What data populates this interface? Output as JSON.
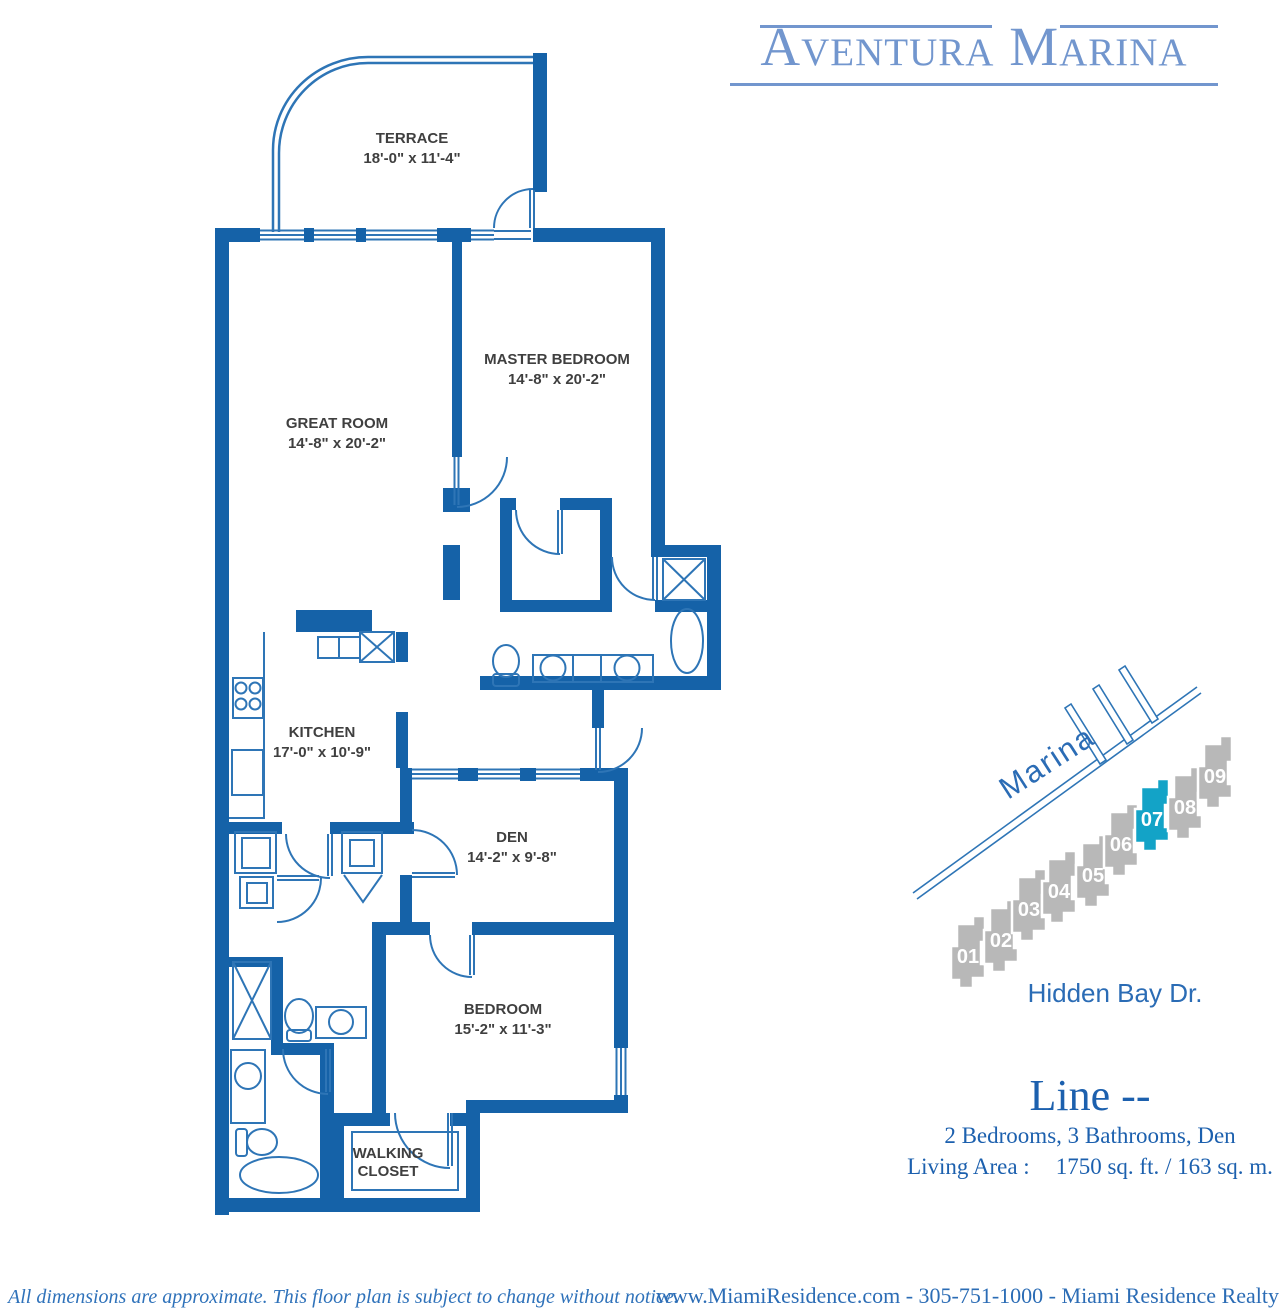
{
  "brand": {
    "logo_text": "Aventura Marina"
  },
  "floorplan": {
    "rooms": {
      "terrace": {
        "name": "TERRACE",
        "dims": "18'-0\" x 11'-4\""
      },
      "master_bedroom": {
        "name": "MASTER BEDROOM",
        "dims": "14'-8\" x 20'-2\""
      },
      "great_room": {
        "name": "GREAT ROOM",
        "dims": "14'-8\" x 20'-2\""
      },
      "kitchen": {
        "name": "KITCHEN",
        "dims": "17'-0\" x 10'-9\""
      },
      "den": {
        "name": "DEN",
        "dims": "14'-2\" x 9'-8\""
      },
      "bedroom": {
        "name": "BEDROOM",
        "dims": "15'-2\" x 11'-3\""
      },
      "walking_closet": {
        "line1": "WALKING",
        "line2": "CLOSET"
      }
    }
  },
  "site_map": {
    "marina_label": "Marina",
    "street_label": "Hidden Bay Dr.",
    "building_color": "#b8b8b8",
    "highlight_color": "#13a3c7",
    "buildings": [
      {
        "label": "01",
        "highlighted": false
      },
      {
        "label": "02",
        "highlighted": false
      },
      {
        "label": "03",
        "highlighted": false
      },
      {
        "label": "04",
        "highlighted": false
      },
      {
        "label": "05",
        "highlighted": false
      },
      {
        "label": "06",
        "highlighted": false
      },
      {
        "label": "07",
        "highlighted": true
      },
      {
        "label": "08",
        "highlighted": false
      },
      {
        "label": "09",
        "highlighted": false
      }
    ]
  },
  "unit_info": {
    "line_title": "Line --",
    "config": "2 Bedrooms, 3 Bathrooms, Den",
    "living_area_label": "Living Area :",
    "living_area_value": "1750 sq. ft. / 163 sq. m."
  },
  "footer": {
    "disclaimer": "All dimensions are approximate.  This floor plan is subject to change without notice.",
    "contact": "www.MiamiResidence.com  -  305-751-1000  -  Miami Residence Realty"
  },
  "colors": {
    "wall_blue": "#1562a8",
    "line_blue": "#2e75b6",
    "label_dark": "#3f3f3f",
    "logo_blue": "#7296ce",
    "serif_blue": "#1c60ae"
  }
}
